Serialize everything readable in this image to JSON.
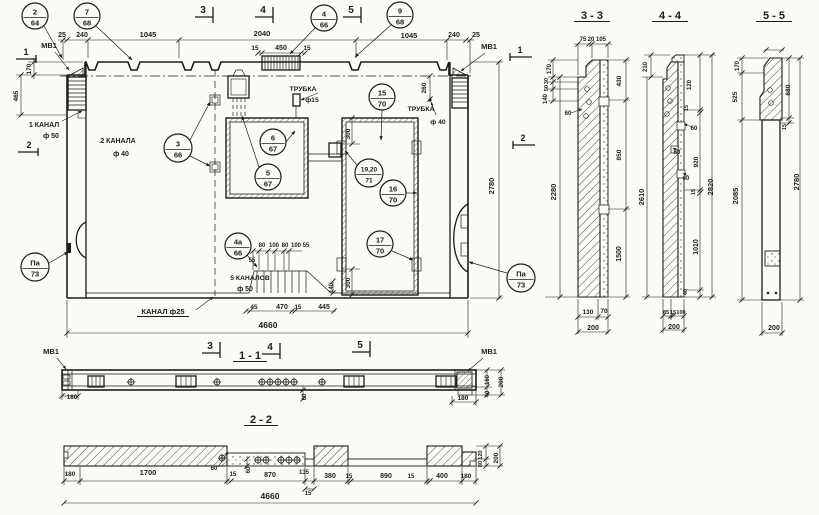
{
  "colors": {
    "ink": "#1c1c1c",
    "paper": "#fbfaf7"
  },
  "annotations": {
    "main_view": [
      {
        "t": "25",
        "x": 62,
        "y": 37,
        "s": 7
      },
      {
        "t": "240",
        "x": 82,
        "y": 37,
        "s": 7
      },
      {
        "t": "1045",
        "x": 148,
        "y": 37,
        "s": 7.5
      },
      {
        "t": "2040",
        "x": 262,
        "y": 36,
        "s": 7.5
      },
      {
        "t": "15",
        "x": 255,
        "y": 50,
        "s": 6.5
      },
      {
        "t": "450",
        "x": 281,
        "y": 50,
        "s": 7
      },
      {
        "t": "15",
        "x": 307,
        "y": 50,
        "s": 6.5
      },
      {
        "t": "1045",
        "x": 409,
        "y": 38,
        "s": 7.5
      },
      {
        "t": "240",
        "x": 454,
        "y": 37,
        "s": 7
      },
      {
        "t": "25",
        "x": 476,
        "y": 37,
        "s": 7
      },
      {
        "t": "МВ1",
        "x": 49,
        "y": 48,
        "s": 7.5
      },
      {
        "t": "МВ1",
        "x": 489,
        "y": 49,
        "s": 7.5
      },
      {
        "t": "170",
        "x": 31,
        "y": 69,
        "s": 6.5,
        "rot": -90
      },
      {
        "t": "465",
        "x": 18,
        "y": 96,
        "s": 6.5,
        "rot": -90
      },
      {
        "t": "1 КАНАЛ",
        "x": 44,
        "y": 127,
        "s": 7
      },
      {
        "t": "ф 50",
        "x": 51,
        "y": 138,
        "s": 7
      },
      {
        "t": "2 КАНАЛА",
        "x": 118,
        "y": 143,
        "s": 7
      },
      {
        "t": "ф 40",
        "x": 121,
        "y": 156,
        "s": 7
      },
      {
        "t": "ТРУБКА",
        "x": 303,
        "y": 91,
        "s": 6.8
      },
      {
        "t": "ф15",
        "x": 312,
        "y": 102,
        "s": 6.8
      },
      {
        "t": "ТРУБКА",
        "x": 421,
        "y": 111,
        "s": 6.8
      },
      {
        "t": "ф 40",
        "x": 438,
        "y": 124,
        "s": 6.8
      },
      {
        "t": "260",
        "x": 426,
        "y": 88,
        "s": 6.5,
        "rot": -90
      },
      {
        "t": "300",
        "x": 350,
        "y": 134,
        "s": 6.5,
        "rot": -90
      },
      {
        "t": "300",
        "x": 350,
        "y": 283,
        "s": 6.5,
        "rot": -90
      },
      {
        "t": "2780",
        "x": 494,
        "y": 186,
        "s": 7.5,
        "rot": -90
      },
      {
        "t": "80",
        "x": 262,
        "y": 247,
        "s": 6
      },
      {
        "t": "100",
        "x": 274,
        "y": 247,
        "s": 6
      },
      {
        "t": "80",
        "x": 285,
        "y": 247,
        "s": 6
      },
      {
        "t": "100",
        "x": 296,
        "y": 247,
        "s": 6
      },
      {
        "t": "55",
        "x": 306,
        "y": 247,
        "s": 6
      },
      {
        "t": "55",
        "x": 252,
        "y": 262,
        "s": 6
      },
      {
        "t": "5 КАНАЛОВ",
        "x": 250,
        "y": 280,
        "s": 6.8
      },
      {
        "t": "ф 50",
        "x": 245,
        "y": 291,
        "s": 7
      },
      {
        "t": "КАНАЛ ф25",
        "x": 163,
        "y": 314,
        "s": 7.5,
        "ul": 52
      },
      {
        "t": "45",
        "x": 254,
        "y": 309,
        "s": 6.5
      },
      {
        "t": "470",
        "x": 282,
        "y": 309,
        "s": 7
      },
      {
        "t": "15",
        "x": 298,
        "y": 309,
        "s": 6
      },
      {
        "t": "445",
        "x": 324,
        "y": 309,
        "s": 7
      },
      {
        "t": "140",
        "x": 333,
        "y": 288,
        "s": 6,
        "rot": -90
      },
      {
        "t": "4660",
        "x": 268,
        "y": 328,
        "s": 8.5
      },
      {
        "t": "1",
        "x": 26,
        "y": 55,
        "s": 9
      },
      {
        "t": "2",
        "x": 29,
        "y": 148,
        "s": 9
      },
      {
        "t": "3",
        "x": 203,
        "y": 13,
        "s": 10
      },
      {
        "t": "4",
        "x": 263,
        "y": 13,
        "s": 10
      },
      {
        "t": "5",
        "x": 351,
        "y": 13,
        "s": 10
      },
      {
        "t": "1",
        "x": 520,
        "y": 53,
        "s": 9
      },
      {
        "t": "2",
        "x": 523,
        "y": 141,
        "s": 9
      }
    ],
    "plan_view_1_1": [
      {
        "t": "1 - 1",
        "x": 250,
        "y": 359,
        "s": 11,
        "ul": 34
      },
      {
        "t": "3",
        "x": 210,
        "y": 349,
        "s": 10
      },
      {
        "t": "4",
        "x": 270,
        "y": 350,
        "s": 10
      },
      {
        "t": "5",
        "x": 360,
        "y": 348,
        "s": 10
      },
      {
        "t": "МВ1",
        "x": 51,
        "y": 354,
        "s": 7.5
      },
      {
        "t": "МВ1",
        "x": 489,
        "y": 354,
        "s": 7.5
      },
      {
        "t": "180",
        "x": 72,
        "y": 399,
        "s": 6.5
      },
      {
        "t": "180",
        "x": 463,
        "y": 400,
        "s": 6.5
      },
      {
        "t": "160",
        "x": 489,
        "y": 380,
        "s": 6,
        "rot": -90
      },
      {
        "t": "40",
        "x": 489,
        "y": 394,
        "s": 6,
        "rot": -90
      },
      {
        "t": "200",
        "x": 503,
        "y": 382,
        "s": 6.5,
        "rot": -90
      },
      {
        "t": "60",
        "x": 306,
        "y": 397,
        "s": 6,
        "rot": -90
      }
    ],
    "section_2_2": [
      {
        "t": "2 - 2",
        "x": 261,
        "y": 423,
        "s": 11,
        "ul": 34
      },
      {
        "t": "180",
        "x": 70,
        "y": 476,
        "s": 6.5
      },
      {
        "t": "1700",
        "x": 148,
        "y": 475,
        "s": 7.5
      },
      {
        "t": "60",
        "x": 214,
        "y": 470,
        "s": 6
      },
      {
        "t": "15",
        "x": 233,
        "y": 476,
        "s": 6
      },
      {
        "t": "60",
        "x": 250,
        "y": 470,
        "s": 6,
        "rot": -90
      },
      {
        "t": "870",
        "x": 270,
        "y": 477,
        "s": 7
      },
      {
        "t": "135",
        "x": 304,
        "y": 474,
        "s": 6
      },
      {
        "t": "380",
        "x": 330,
        "y": 478,
        "s": 7
      },
      {
        "t": "15",
        "x": 349,
        "y": 478,
        "s": 6
      },
      {
        "t": "890",
        "x": 386,
        "y": 478,
        "s": 7
      },
      {
        "t": "15",
        "x": 411,
        "y": 478,
        "s": 6
      },
      {
        "t": "400",
        "x": 442,
        "y": 478,
        "s": 7
      },
      {
        "t": "180",
        "x": 466,
        "y": 478,
        "s": 6.5
      },
      {
        "t": "15",
        "x": 308,
        "y": 495,
        "s": 6
      },
      {
        "t": "120",
        "x": 482,
        "y": 455,
        "s": 5.5,
        "rot": -90
      },
      {
        "t": "80",
        "x": 482,
        "y": 464,
        "s": 5.5,
        "rot": -90
      },
      {
        "t": "200",
        "x": 498,
        "y": 458,
        "s": 6.5,
        "rot": -90
      },
      {
        "t": "4660",
        "x": 270,
        "y": 499,
        "s": 8.5
      }
    ],
    "section_3_3": [
      {
        "t": "3 - 3",
        "x": 592,
        "y": 19,
        "s": 11,
        "ul": 36
      },
      {
        "t": "75",
        "x": 583,
        "y": 41,
        "s": 6
      },
      {
        "t": "20",
        "x": 591,
        "y": 41,
        "s": 6
      },
      {
        "t": "105",
        "x": 601,
        "y": 41,
        "s": 6
      },
      {
        "t": "170",
        "x": 551,
        "y": 69,
        "s": 6,
        "rot": -90
      },
      {
        "t": "30",
        "x": 548,
        "y": 81,
        "s": 5.5,
        "rot": -90
      },
      {
        "t": "50",
        "x": 548,
        "y": 88,
        "s": 5.5,
        "rot": -90
      },
      {
        "t": "140",
        "x": 547,
        "y": 99,
        "s": 6,
        "rot": -90
      },
      {
        "t": "60",
        "x": 568,
        "y": 115,
        "s": 6
      },
      {
        "t": "2280",
        "x": 556,
        "y": 192,
        "s": 7.5,
        "rot": -90
      },
      {
        "t": "430",
        "x": 621,
        "y": 81,
        "s": 6.5,
        "rot": -90
      },
      {
        "t": "850",
        "x": 621,
        "y": 155,
        "s": 6.5,
        "rot": -90
      },
      {
        "t": "1500",
        "x": 621,
        "y": 254,
        "s": 7,
        "rot": -90
      },
      {
        "t": "130",
        "x": 588,
        "y": 314,
        "s": 6.5
      },
      {
        "t": "70",
        "x": 604,
        "y": 313,
        "s": 6.5
      },
      {
        "t": "200",
        "x": 593,
        "y": 330,
        "s": 7
      }
    ],
    "section_4_4": [
      {
        "t": "4 - 4",
        "x": 670,
        "y": 19,
        "s": 11,
        "ul": 36
      },
      {
        "t": "210",
        "x": 647,
        "y": 67,
        "s": 6,
        "rot": -90
      },
      {
        "t": "120",
        "x": 691,
        "y": 85,
        "s": 6,
        "rot": -90
      },
      {
        "t": "15",
        "x": 688,
        "y": 108,
        "s": 5.5,
        "rot": -90
      },
      {
        "t": "60",
        "x": 694,
        "y": 130,
        "s": 6
      },
      {
        "t": "60",
        "x": 677,
        "y": 154,
        "s": 6
      },
      {
        "t": "920",
        "x": 698,
        "y": 162,
        "s": 6.5,
        "rot": -90
      },
      {
        "t": "60",
        "x": 686,
        "y": 180,
        "s": 6
      },
      {
        "t": "15",
        "x": 695,
        "y": 192,
        "s": 5.5,
        "rot": -90
      },
      {
        "t": "1010",
        "x": 698,
        "y": 247,
        "s": 7,
        "rot": -90
      },
      {
        "t": "40",
        "x": 687,
        "y": 292,
        "s": 5.5,
        "rot": -90
      },
      {
        "t": "2820",
        "x": 713,
        "y": 187,
        "s": 7.5,
        "rot": -90
      },
      {
        "t": "2610",
        "x": 644,
        "y": 197,
        "s": 7.5,
        "rot": -90
      },
      {
        "t": "85",
        "x": 666,
        "y": 314,
        "s": 5.5
      },
      {
        "t": "15",
        "x": 673,
        "y": 314,
        "s": 5.5
      },
      {
        "t": "100",
        "x": 681,
        "y": 314,
        "s": 5.5
      },
      {
        "t": "200",
        "x": 674,
        "y": 329,
        "s": 7
      }
    ],
    "section_5_5": [
      {
        "t": "5 - 5",
        "x": 774,
        "y": 19,
        "s": 11,
        "ul": 36
      },
      {
        "t": "170",
        "x": 739,
        "y": 66,
        "s": 6,
        "rot": -90
      },
      {
        "t": "525",
        "x": 737,
        "y": 97,
        "s": 6.5,
        "rot": -90
      },
      {
        "t": "2085",
        "x": 738,
        "y": 196,
        "s": 7.5,
        "rot": -90
      },
      {
        "t": "680",
        "x": 790,
        "y": 90,
        "s": 6.5,
        "rot": -90
      },
      {
        "t": "15",
        "x": 786,
        "y": 127,
        "s": 5.5,
        "rot": -90
      },
      {
        "t": "2780",
        "x": 799,
        "y": 182,
        "s": 7.5,
        "rot": -90
      },
      {
        "t": "200",
        "x": 774,
        "y": 330,
        "s": 7
      }
    ]
  },
  "callouts": [
    {
      "top": "2",
      "bot": "64",
      "cx": 35,
      "cy": 16,
      "r": 13,
      "ld": [
        [
          44,
          26,
          62,
          58
        ]
      ]
    },
    {
      "top": "7",
      "bot": "68",
      "cx": 87,
      "cy": 16,
      "r": 13,
      "ld": [
        [
          96,
          26,
          132,
          60
        ]
      ]
    },
    {
      "top": "4",
      "bot": "66",
      "cx": 324,
      "cy": 18,
      "r": 13,
      "ld": [
        [
          315,
          28,
          290,
          54
        ]
      ]
    },
    {
      "top": "9",
      "bot": "68",
      "cx": 400,
      "cy": 15,
      "r": 13,
      "ld": [
        [
          391,
          25,
          355,
          57
        ]
      ]
    },
    {
      "top": "3",
      "bot": "66",
      "cx": 178,
      "cy": 148,
      "r": 14,
      "ld": [
        [
          190,
          140,
          210,
          102
        ],
        [
          190,
          156,
          210,
          166
        ]
      ]
    },
    {
      "top": "6",
      "bot": "67",
      "cx": 273,
      "cy": 142,
      "r": 13,
      "ld": [
        [
          286,
          142,
          295,
          131
        ]
      ]
    },
    {
      "top": "5",
      "bot": "67",
      "cx": 268,
      "cy": 177,
      "r": 13,
      "ld": [
        [
          259,
          167,
          242,
          116
        ]
      ]
    },
    {
      "top": "15",
      "bot": "70",
      "cx": 382,
      "cy": 97,
      "r": 13,
      "ld": [
        [
          382,
          110,
          381,
          140
        ]
      ]
    },
    {
      "top": "19,20",
      "bot": "71",
      "cx": 369,
      "cy": 173,
      "r": 14,
      "fs": 6.5,
      "ld": [
        [
          357,
          165,
          345,
          151
        ]
      ]
    },
    {
      "top": "16",
      "bot": "70",
      "cx": 393,
      "cy": 193,
      "r": 13,
      "ld": [
        [
          406,
          193,
          417,
          193
        ]
      ]
    },
    {
      "top": "17",
      "bot": "70",
      "cx": 380,
      "cy": 244,
      "r": 13,
      "ld": [
        [
          392,
          251,
          413,
          260
        ]
      ]
    },
    {
      "top": "4а",
      "bot": "66",
      "cx": 238,
      "cy": 246,
      "r": 13,
      "ld": [
        [
          247,
          255,
          257,
          267
        ]
      ]
    },
    {
      "top": "Па",
      "bot": "73",
      "cx": 35,
      "cy": 267,
      "r": 14,
      "ld": [
        [
          49,
          263,
          68,
          252
        ]
      ]
    },
    {
      "top": "Па",
      "bot": "73",
      "cx": 521,
      "cy": 278,
      "r": 14,
      "ld": [
        [
          507,
          273,
          469,
          262
        ]
      ]
    }
  ]
}
